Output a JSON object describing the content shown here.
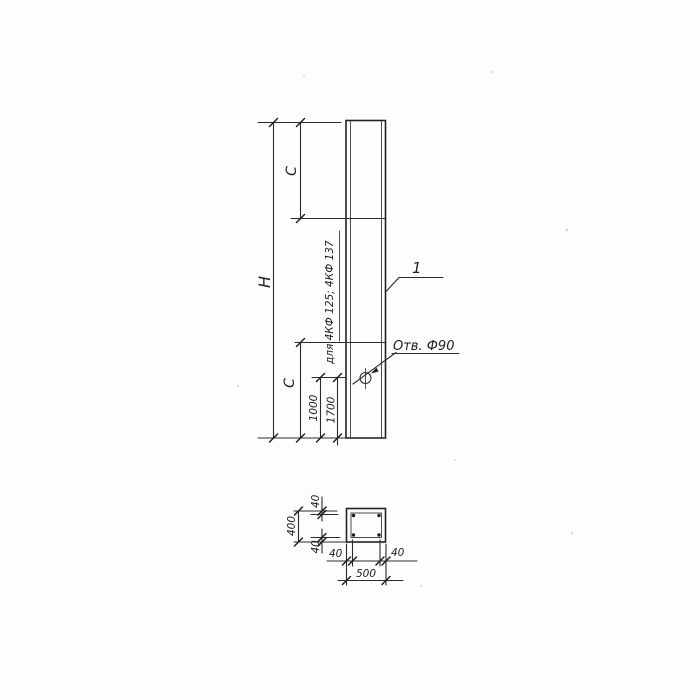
{
  "drawing": {
    "colors": {
      "ink": "#2a2a2a",
      "paper": "#fdfdfc"
    },
    "elevation": {
      "height_label": "H",
      "span_top_label": "C",
      "span_bottom_label": "C",
      "hole_offset_dims": [
        "1000",
        "1700"
      ],
      "variant_note": "для 4КФ 125; 4КФ 137",
      "hole_label": "Отв. Ф90",
      "part_number": "1"
    },
    "section": {
      "width_dim": "500",
      "height_dim": "400",
      "wall_top": "40",
      "wall_bottom": "40",
      "wall_left": "40",
      "wall_right": "40"
    }
  }
}
